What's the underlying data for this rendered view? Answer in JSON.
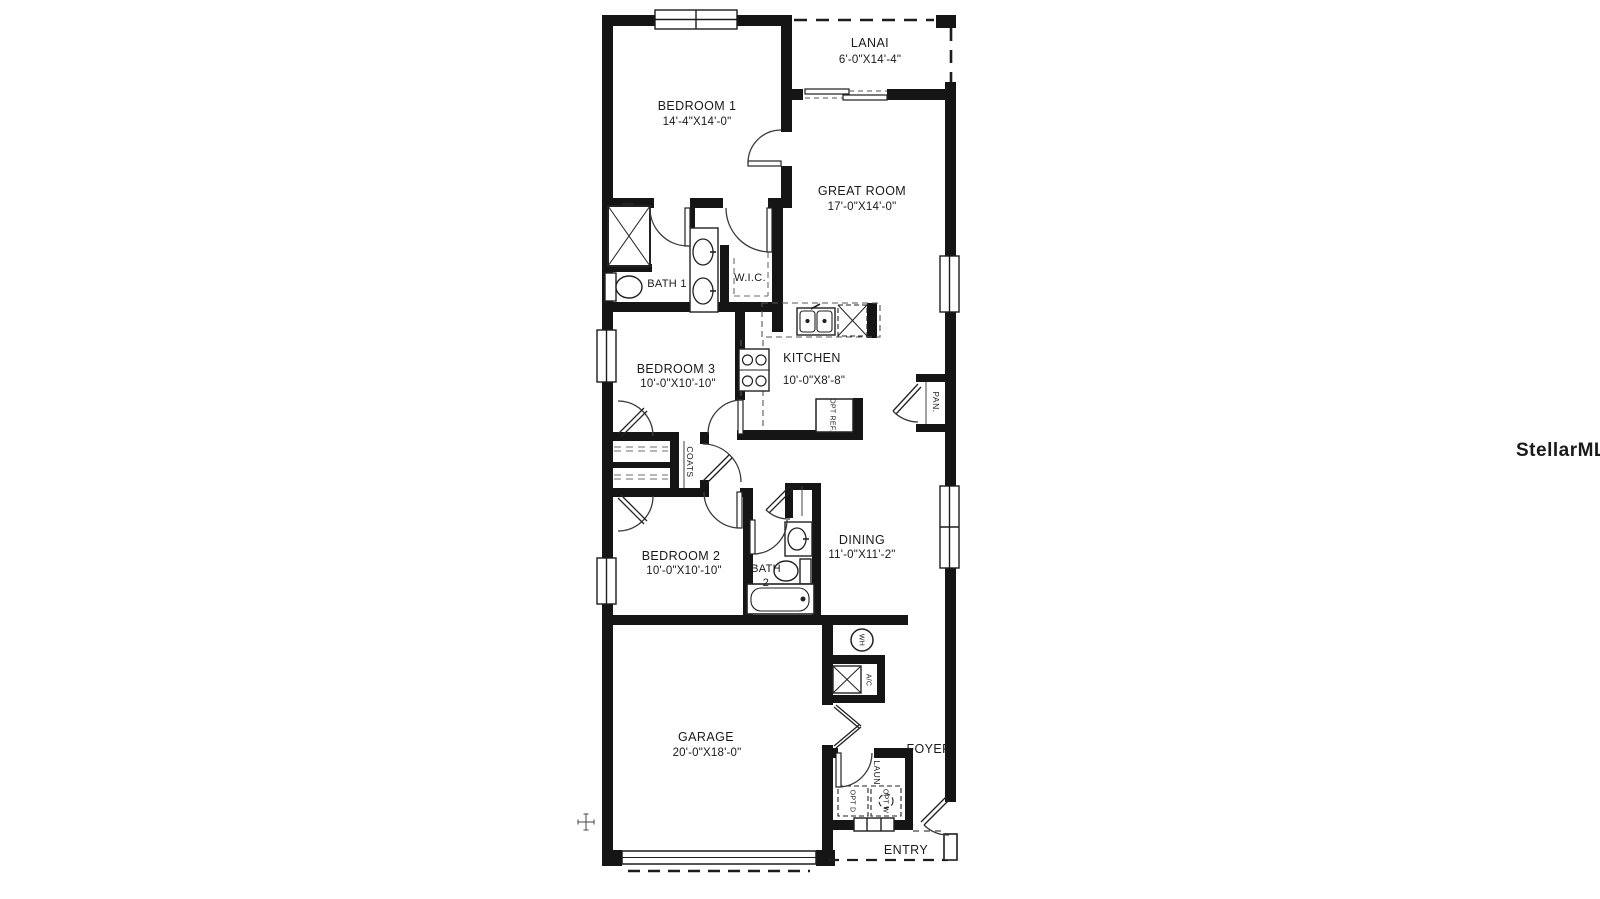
{
  "watermark": "StellarMLS",
  "rooms": {
    "lanai": {
      "name": "LANAI",
      "dims": "6'-0\"X14'-4\""
    },
    "bedroom1": {
      "name": "BEDROOM 1",
      "dims": "14'-4\"X14'-0\""
    },
    "great_room": {
      "name": "GREAT ROOM",
      "dims": "17'-0\"X14'-0\""
    },
    "bath1": {
      "name": "BATH 1"
    },
    "wic": {
      "name": "W.I.C."
    },
    "kitchen": {
      "name": "KITCHEN",
      "dims": "10'-0\"X8'-8\""
    },
    "bedroom3": {
      "name": "BEDROOM 3",
      "dims": "10'-0\"X10'-10\""
    },
    "pantry": {
      "name": "PAN."
    },
    "coats": {
      "name": "COATS"
    },
    "bedroom2": {
      "name": "BEDROOM 2",
      "dims": "10'-0\"X10'-10\""
    },
    "bath2": {
      "name": "BATH",
      "number": "2"
    },
    "dining": {
      "name": "DINING",
      "dims": "11'-0\"X11'-2\""
    },
    "garage": {
      "name": "GARAGE",
      "dims": "20'-0\"X18'-0\""
    },
    "laundry": {
      "name": "LAUN."
    },
    "foyer": {
      "name": "FOYER"
    },
    "entry": {
      "name": "ENTRY"
    }
  },
  "fixtures": {
    "water_heater": "WH",
    "ac": "A/C",
    "opt_ref": "OPT REF.",
    "opt_dryer": "OPT D",
    "opt_washer": "OPT W"
  },
  "colors": {
    "wall": "#151515",
    "line": "#3a3a3a",
    "dash": "#6e6e6e",
    "watermark": "#ededed"
  }
}
